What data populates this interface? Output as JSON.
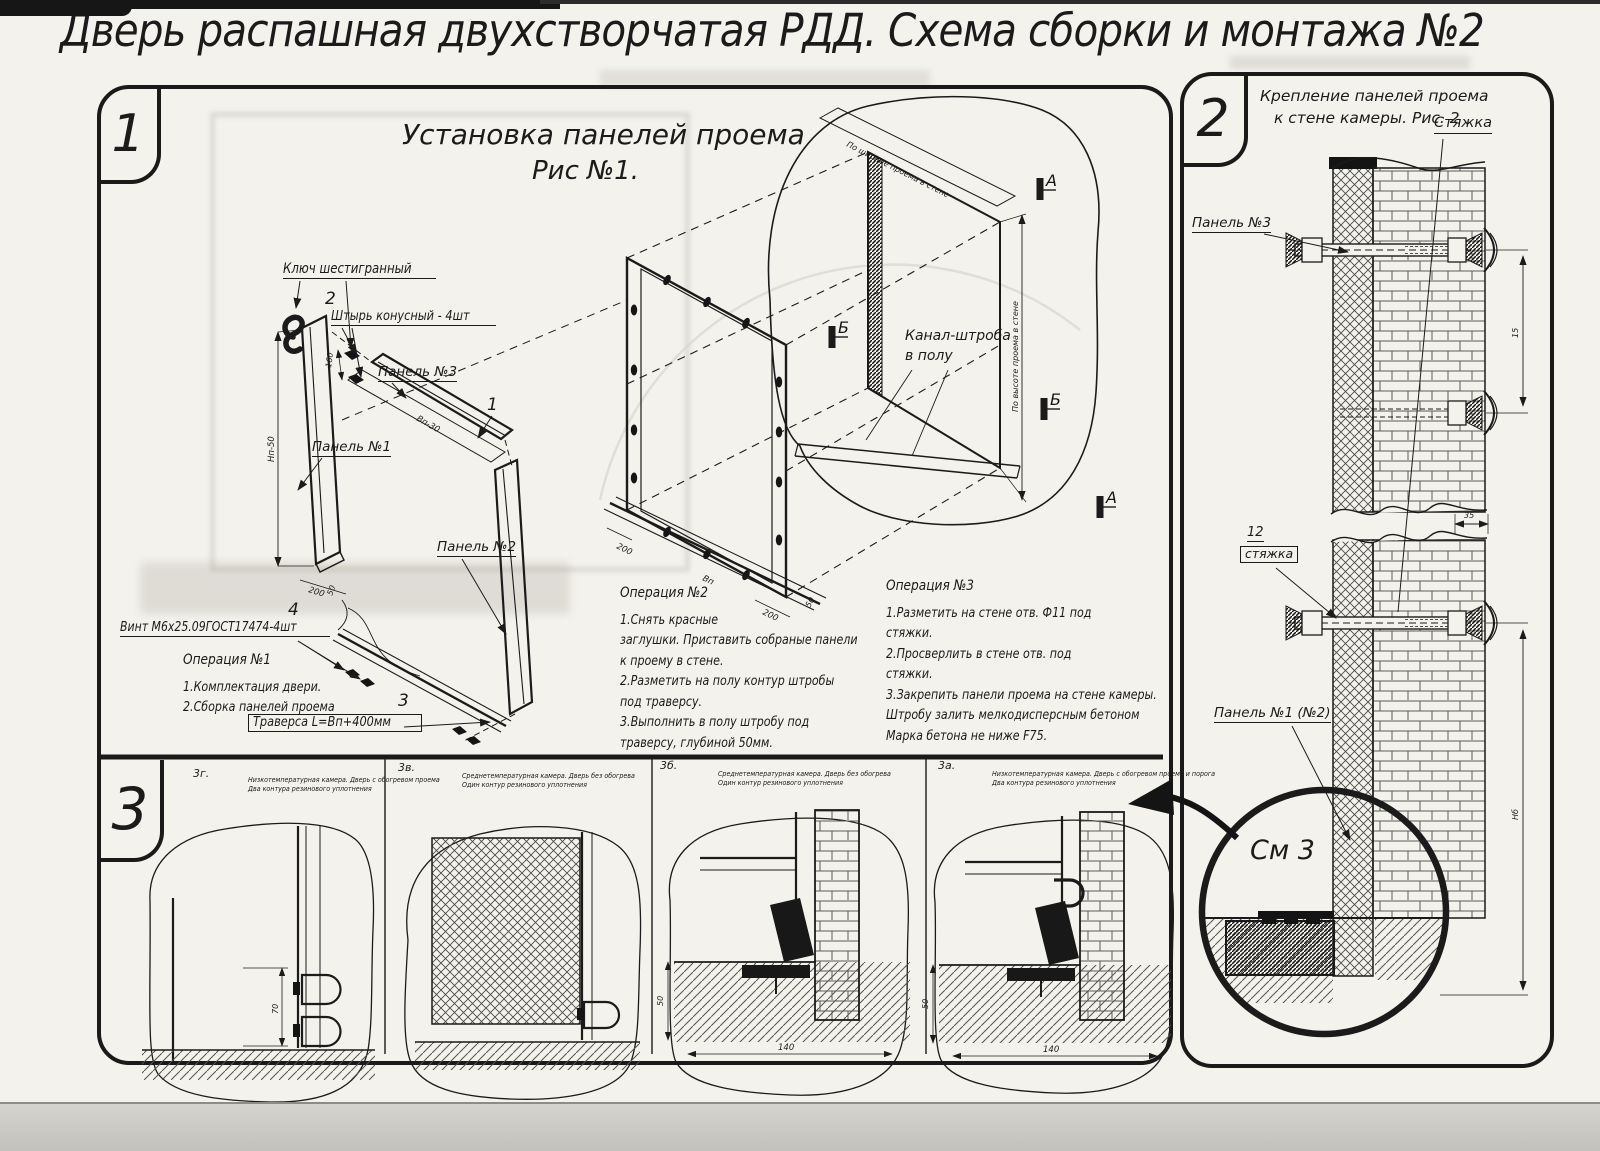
{
  "sheet": {
    "title": "Дверь распашная двухстворчатая РДД.  Схема сборки и монтажа №2"
  },
  "fig1": {
    "badge": "1",
    "title1": "Установка панелей проема",
    "title2": "Рис №1.",
    "callouts": {
      "hex_key": "Ключ шестигранный",
      "pin_no": "2",
      "pin": "Штырь конусный - 4шт",
      "panel3": "Панель №3",
      "panel3_no": "1",
      "panel1": "Панель №1",
      "panel2": "Панель №2",
      "screw_no": "4",
      "screw": "Винт М6х25.09ГОСТ17474-4шт",
      "traverse_no": "3",
      "traverse": "Траверса  L=Вп+400мм",
      "channel1": "Канал-штроба",
      "channel2": "в полу"
    },
    "dims": {
      "d160": "160",
      "d200": "200",
      "h_panel": "Нп-50",
      "w_panel": "Вп-30",
      "d50": "50",
      "w_frame": "Вп",
      "by_width": "По ширине проема в стене",
      "by_height": "По высоте проема в стене",
      "sec_a": "А",
      "sec_b": "Б"
    },
    "op1": {
      "title": "Операция №1",
      "l1": "1.Комплектация двери.",
      "l2": "2.Сборка панелей проема"
    },
    "op2": {
      "title": "Операция №2",
      "l1": "1.Снять красные",
      "l2": "заглушки. Приставить собраные панели",
      "l3": "к проему в стене.",
      "l4": "2.Разметить на полу контур штробы",
      "l5": "под траверсу.",
      "l6": "3.Выполнить в полу штробу под",
      "l7": "траверсу, глубиной 50мм."
    },
    "op3": {
      "title": "Операция №3",
      "l1": "1.Разметить на стене отв. Ф11 под",
      "l2": "стяжки.",
      "l3": "2.Просверлить в стене отв.  под",
      "l4": "стяжки.",
      "l5": "3.Закрепить панели проема на стене камеры.",
      "l6": "Штробу залить мелкодисперсным бетоном",
      "l7": "Марка бетона не ниже  F75."
    }
  },
  "fig2": {
    "badge": "2",
    "title1": "Крепление панелей проема",
    "title2": "к стене камеры. Рис. 2",
    "callouts": {
      "tie": "Стяжка",
      "panel3": "Панель №3",
      "tie_no": "12",
      "tie_small": "стяжка",
      "panel1": "Панель №1 (№2)",
      "see": "См 3"
    },
    "dims": {
      "d15": "15",
      "d35": "35",
      "hb": "Нб"
    }
  },
  "fig3": {
    "badge": "3",
    "subs": [
      {
        "id": "3г.",
        "d1": "Низкотемпературная камера. Дверь с обогревом проема",
        "d2": "Два контура резинового уплотнения"
      },
      {
        "id": "3в.",
        "d1": "Среднетемпературная камера. Дверь без обогрева",
        "d2": "Один контур резинового уплотнения"
      },
      {
        "id": "3б.",
        "d1": "Среднетемпературная камера. Дверь без обогрева",
        "d2": "Один контур резинового уплотнения"
      },
      {
        "id": "3а.",
        "d1": "Низкотемпературная камера. Дверь с обогревом проема и порога",
        "d2": "Два контура резинового уплотнения"
      }
    ],
    "dims": {
      "d70": "70",
      "d140": "140",
      "d50": "50"
    }
  }
}
